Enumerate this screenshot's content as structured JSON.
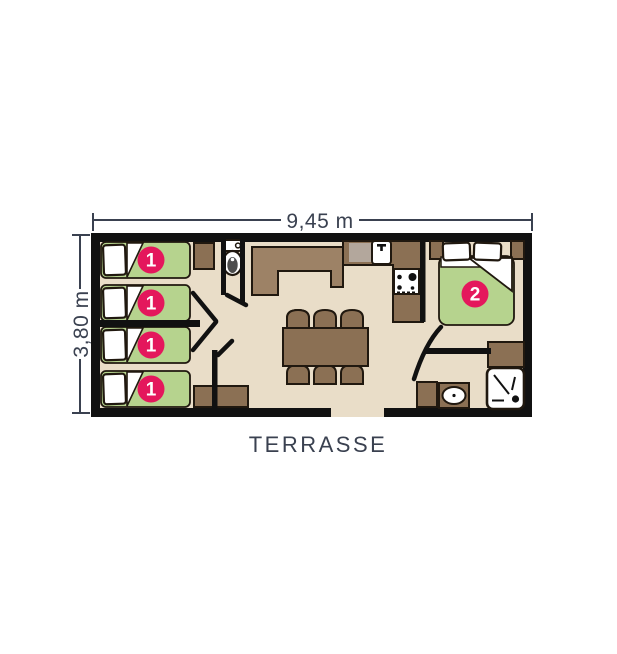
{
  "dimensions": {
    "width_label": "9,45 m",
    "height_label": "3,80 m"
  },
  "labels": {
    "terrace": "TERRASSE"
  },
  "markers": {
    "single_bed": "1",
    "double_bed": "2"
  },
  "icons": {
    "toilet": "toilet-icon",
    "kitchen_faucet": "faucet-icon",
    "stove": "stove-burners-icon",
    "shower": "shower-icon",
    "bathroom_sink": "bathroom-sink-icon"
  },
  "colors": {
    "accent_pink": "#e4175c",
    "bed_green": "#b6d38e",
    "floor_beige": "#e9ddc8",
    "furniture_brown": "#8b7054",
    "furniture_light_brown": "#9d8266",
    "drainer_gray": "#b3a79c",
    "wall_black": "#111111",
    "outline_dark": "#20180f",
    "text_slate": "#3a4150",
    "toilet_seat_gray": "#4d4d4d"
  }
}
